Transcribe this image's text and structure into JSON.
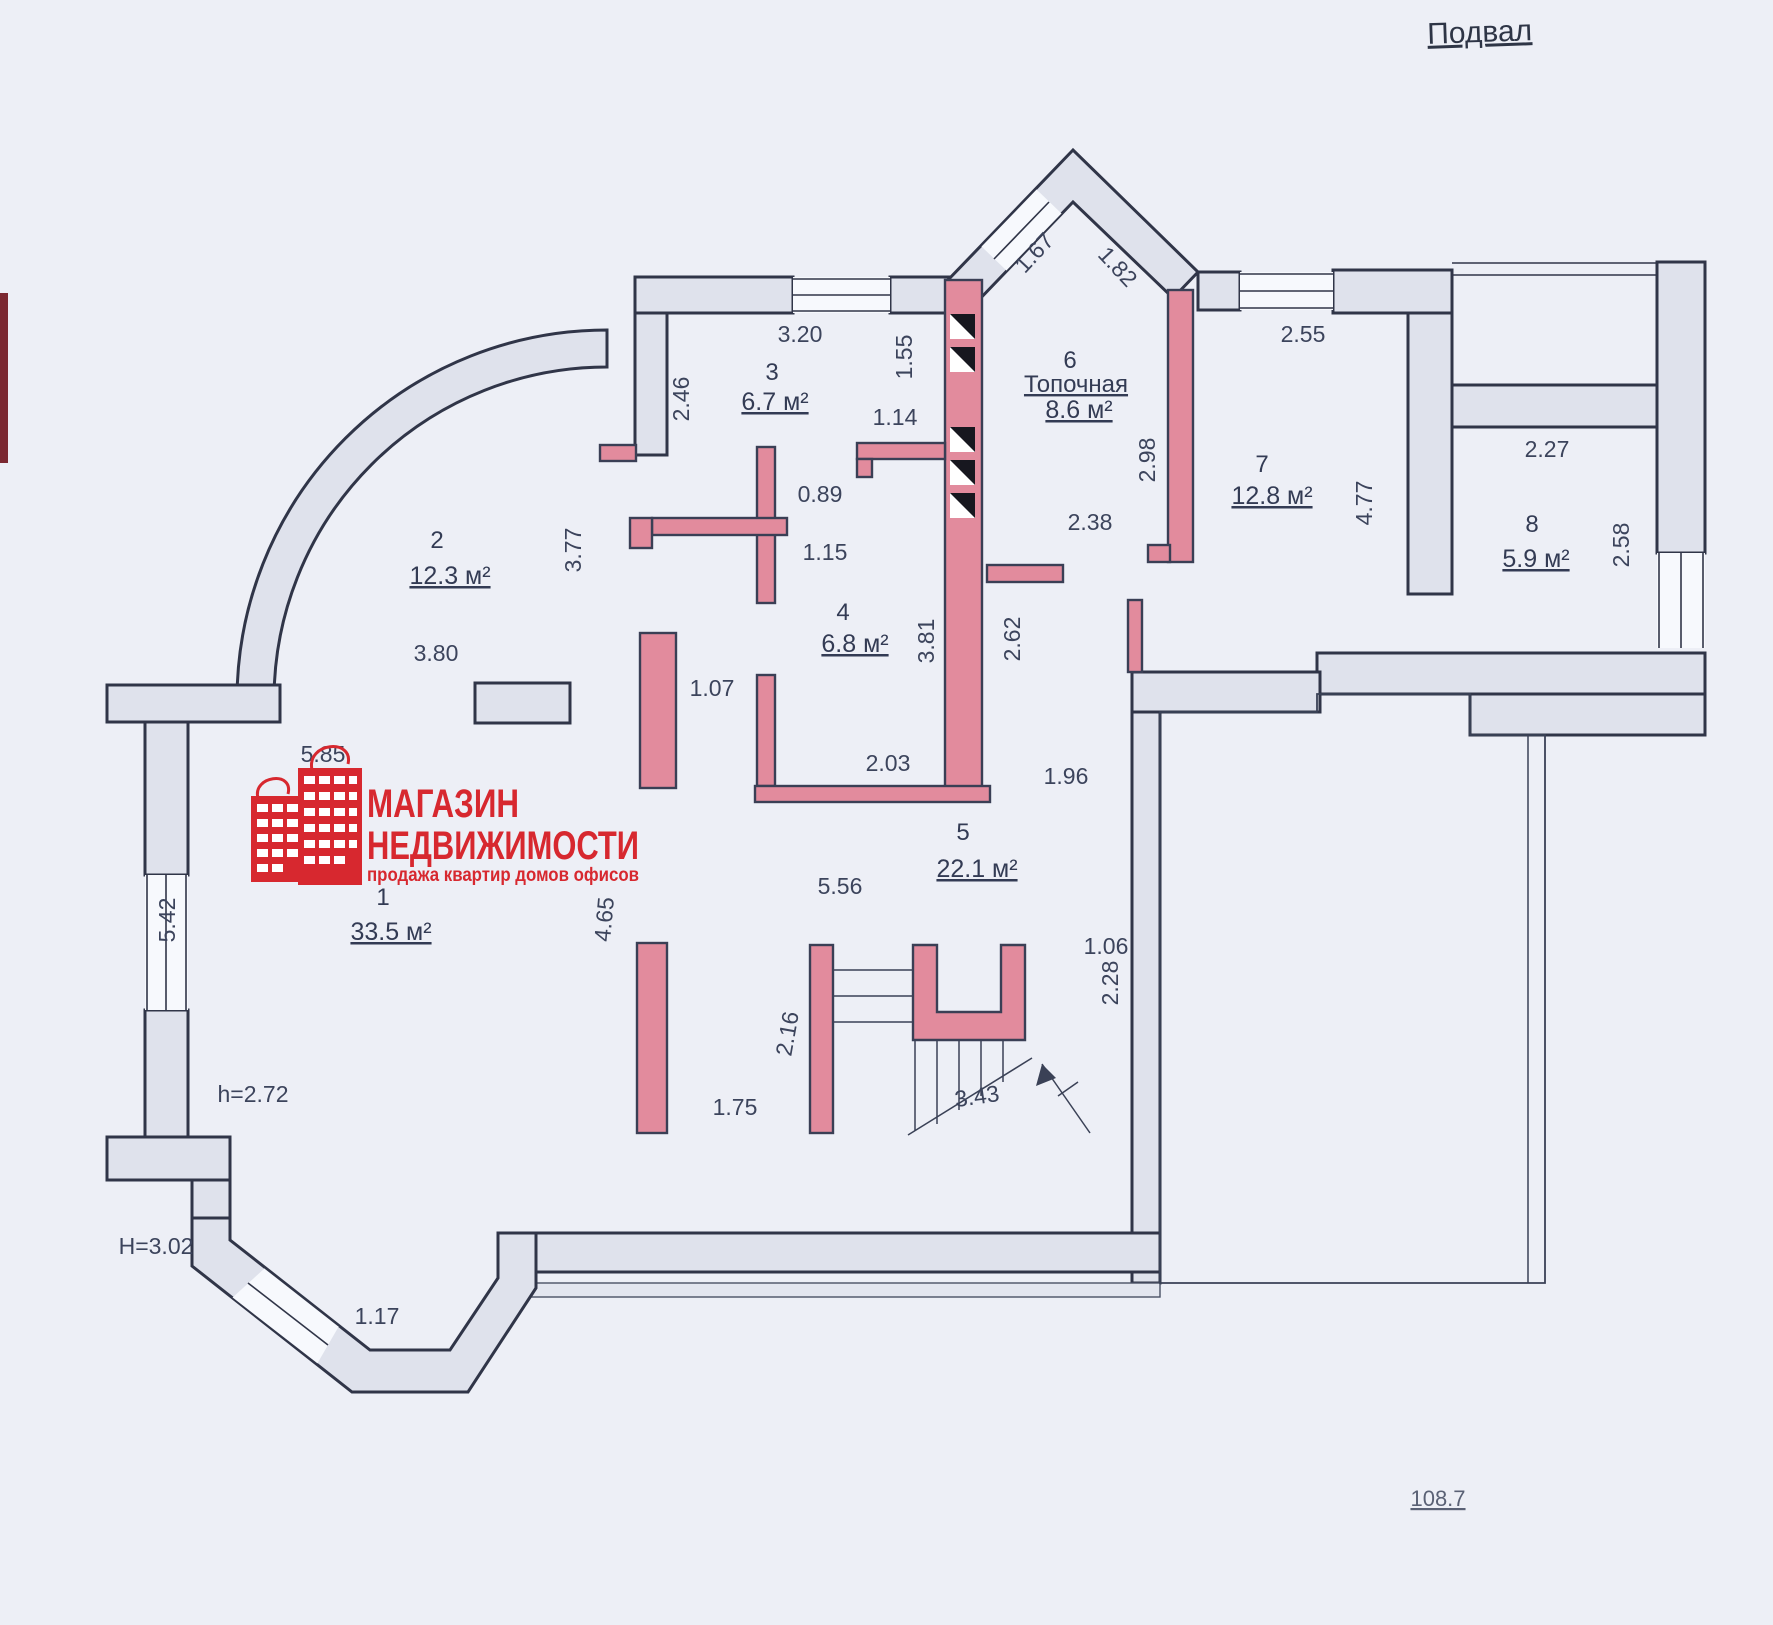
{
  "title": "Подвал",
  "total_area": "108.7",
  "logo": {
    "line1": "МАГАЗИН",
    "line2": "НЕДВИЖИМОСТИ",
    "tagline": "продажа  квартир  домов  офисов"
  },
  "rooms": [
    {
      "number": "1",
      "area": "33.5 м²"
    },
    {
      "number": "2",
      "area": "12.3 м²"
    },
    {
      "number": "3",
      "area": "6.7 м²"
    },
    {
      "number": "4",
      "area": "6.8 м²"
    },
    {
      "number": "5",
      "area": "22.1 м²"
    },
    {
      "number": "6",
      "name": "Топочная",
      "area": "8.6 м²"
    },
    {
      "number": "7",
      "area": "12.8 м²"
    },
    {
      "number": "8",
      "area": "5.9 м²"
    }
  ],
  "heights": {
    "h_small": "h=2.72",
    "h_main": "H=3.02"
  },
  "dims": {
    "d320": "3.20",
    "d246": "2.46",
    "d155": "1.55",
    "d167": "1.67",
    "d182": "1.82",
    "d255": "2.55",
    "d114": "1.14",
    "d089": "0.89",
    "d115": "1.15",
    "d238": "2.38",
    "d298": "2.98",
    "d477": "4.77",
    "d227": "2.27",
    "d258": "2.58",
    "d377": "3.77",
    "d380": "3.80",
    "d107": "1.07",
    "d381": "3.81",
    "d262": "2.62",
    "d203": "2.03",
    "d196": "1.96",
    "d585": "5.85",
    "d542": "5.42",
    "d465": "4.65",
    "d556": "5.56",
    "d216": "2.16",
    "d175": "1.75",
    "d343": "3.43",
    "d106": "1.06",
    "d228": "2.28",
    "d117": "1.17"
  },
  "colors": {
    "accent_red": "#d7282f",
    "wall_fill": "#dfe2ec",
    "partition_pink": "#e28b9d",
    "line": "#303548",
    "paper": "#edeff6"
  }
}
